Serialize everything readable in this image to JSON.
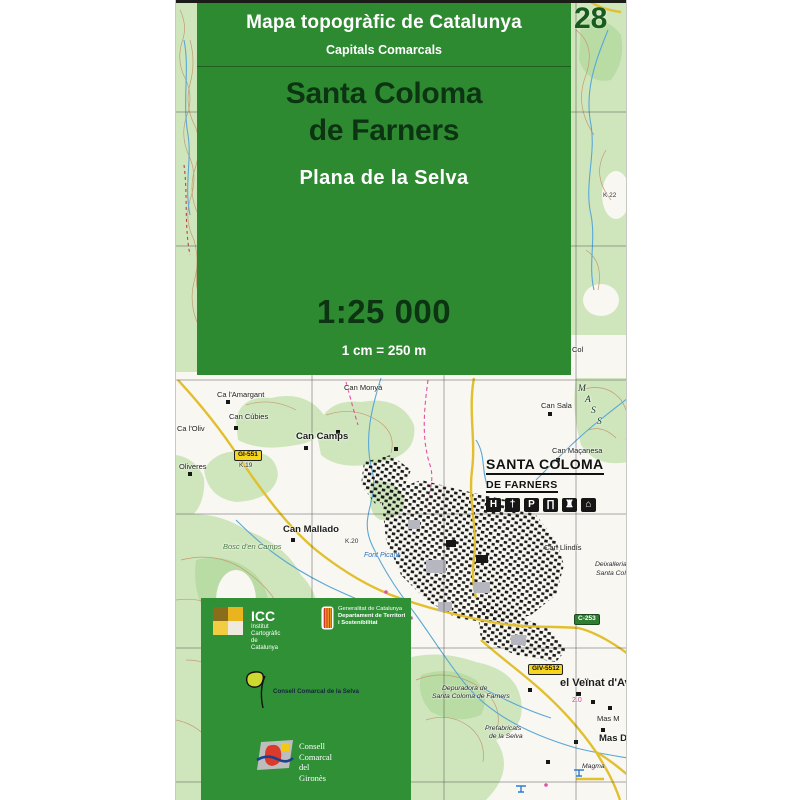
{
  "cover": {
    "series_title": "Mapa topogràfic de Catalunya",
    "series_subtitle": "Capitals Comarcals",
    "sheet_number": "28",
    "title_line1": "Santa Coloma",
    "title_line2": "de Farners",
    "subtitle": "Plana de la Selva",
    "scale": "1:25 000",
    "scale_note": "1 cm = 250 m",
    "colors": {
      "panel_green": "#2e8a31",
      "band_green": "#2f9036",
      "title_dark_green": "#0c3413",
      "sheet_number_green": "#175c1e",
      "shield_yellow": "#f6d51f",
      "shield_green": "#2f7d33",
      "road_yellow": "#e2bf2e",
      "forest_green": "#cfe6bd",
      "water_blue": "#5aa7d6",
      "contour_tan": "#c49a72"
    }
  },
  "town": {
    "line1": "SANTA COLOMA",
    "line2": "DE FARNERS",
    "pictograms": [
      {
        "text": "H",
        "name": "hospital-icon"
      },
      {
        "text": "†",
        "name": "church-icon"
      },
      {
        "text": "P",
        "name": "parking-icon"
      },
      {
        "text": "∏",
        "name": "museum-icon"
      },
      {
        "text": "♜",
        "name": "castle-icon"
      },
      {
        "text": "⌂",
        "name": "heritage-houses-icon"
      }
    ]
  },
  "map": {
    "labels": [
      {
        "text": "K 22",
        "x": 427,
        "y": 193,
        "cls": "xtiny",
        "name": "km-marker-label"
      },
      {
        "text": "Col",
        "x": 396,
        "y": 346,
        "name": "place-label"
      },
      {
        "text": "M",
        "x": 402,
        "y": 385,
        "cls": "mass",
        "name": "massif-letter"
      },
      {
        "text": "A",
        "x": 409,
        "y": 396,
        "cls": "mass",
        "name": "massif-letter"
      },
      {
        "text": "S",
        "x": 415,
        "y": 407,
        "cls": "mass",
        "name": "massif-letter"
      },
      {
        "text": "S",
        "x": 421,
        "y": 418,
        "cls": "mass",
        "name": "massif-letter"
      },
      {
        "text": "Can Monyà",
        "x": 168,
        "y": 384,
        "name": "farm-label"
      },
      {
        "text": "Ca l'Amargant",
        "x": 41,
        "y": 391,
        "name": "farm-label"
      },
      {
        "text": "Can Sala",
        "x": 365,
        "y": 402,
        "name": "farm-label"
      },
      {
        "text": "Can Cúbies",
        "x": 53,
        "y": 413,
        "name": "farm-label"
      },
      {
        "text": "Ca l'Oliv",
        "x": 1,
        "y": 425,
        "name": "farm-label"
      },
      {
        "text": "Can Camps",
        "x": 120,
        "y": 432,
        "cls": "bold",
        "name": "village-label"
      },
      {
        "text": "Can Maçanesa",
        "x": 376,
        "y": 447,
        "name": "farm-label"
      },
      {
        "text": "GI-551",
        "x": 58,
        "y": 450,
        "cls": "shield-y",
        "name": "road-shield"
      },
      {
        "text": "Oliveres",
        "x": 3,
        "y": 463,
        "name": "farm-label"
      },
      {
        "text": "K.19",
        "x": 63,
        "y": 463,
        "cls": "xtiny",
        "name": "km-marker-label"
      },
      {
        "text": "Can Mallado",
        "x": 107,
        "y": 525,
        "cls": "bold",
        "name": "village-label"
      },
      {
        "text": "K.20",
        "x": 169,
        "y": 539,
        "cls": "xtiny",
        "name": "km-marker-label"
      },
      {
        "text": "Bosc d'en Camps",
        "x": 47,
        "y": 543,
        "cls": "igreen",
        "name": "forest-label"
      },
      {
        "text": "Can Llindís",
        "x": 368,
        "y": 544,
        "name": "farm-label"
      },
      {
        "text": "Font Picant",
        "x": 188,
        "y": 552,
        "cls": "iblue",
        "name": "spring-label"
      },
      {
        "text": "Deixalleria",
        "x": 419,
        "y": 562,
        "cls": "italic",
        "name": "facility-label"
      },
      {
        "text": "Santa Colo",
        "x": 420,
        "y": 571,
        "cls": "italic",
        "name": "facility-label"
      },
      {
        "text": "C-253",
        "x": 398,
        "y": 614,
        "cls": "shield-g",
        "name": "road-shield"
      },
      {
        "text": "GIV-5512",
        "x": 352,
        "y": 664,
        "cls": "shield-y",
        "name": "road-shield"
      },
      {
        "text": "el Veïnat d'Av",
        "x": 384,
        "y": 678,
        "cls": "big",
        "name": "village-label"
      },
      {
        "text": "Depuradora de",
        "x": 266,
        "y": 686,
        "cls": "italic",
        "name": "facility-label"
      },
      {
        "text": "Santa Coloma de Farners",
        "x": 256,
        "y": 694,
        "cls": "italic",
        "name": "facility-label"
      },
      {
        "text": "2.0",
        "x": 396,
        "y": 697,
        "cls": "pink",
        "name": "distance-label"
      },
      {
        "text": "Mas M",
        "x": 421,
        "y": 715,
        "name": "farm-label"
      },
      {
        "text": "Prefabricats",
        "x": 309,
        "y": 726,
        "cls": "italic",
        "name": "facility-label"
      },
      {
        "text": "de la Selva",
        "x": 313,
        "y": 734,
        "cls": "italic",
        "name": "facility-label"
      },
      {
        "text": "Mas D",
        "x": 423,
        "y": 734,
        "cls": "bold",
        "name": "village-label"
      },
      {
        "text": "Magma",
        "x": 406,
        "y": 764,
        "cls": "italic",
        "name": "facility-label"
      }
    ]
  },
  "publishers": {
    "icc": {
      "acronym": "ICC",
      "line1": "Institut Cartogràfic",
      "line2": "de Catalunya"
    },
    "generalitat": {
      "line1": "Generalitat de Catalunya",
      "line2": "Departament de Territori",
      "line3": "i Sostenibilitat"
    },
    "selva": {
      "label": "Consell Comarcal de la Selva"
    },
    "girones": {
      "line1": "Consell",
      "line2": "Comarcal",
      "line3": "del Gironès"
    }
  }
}
